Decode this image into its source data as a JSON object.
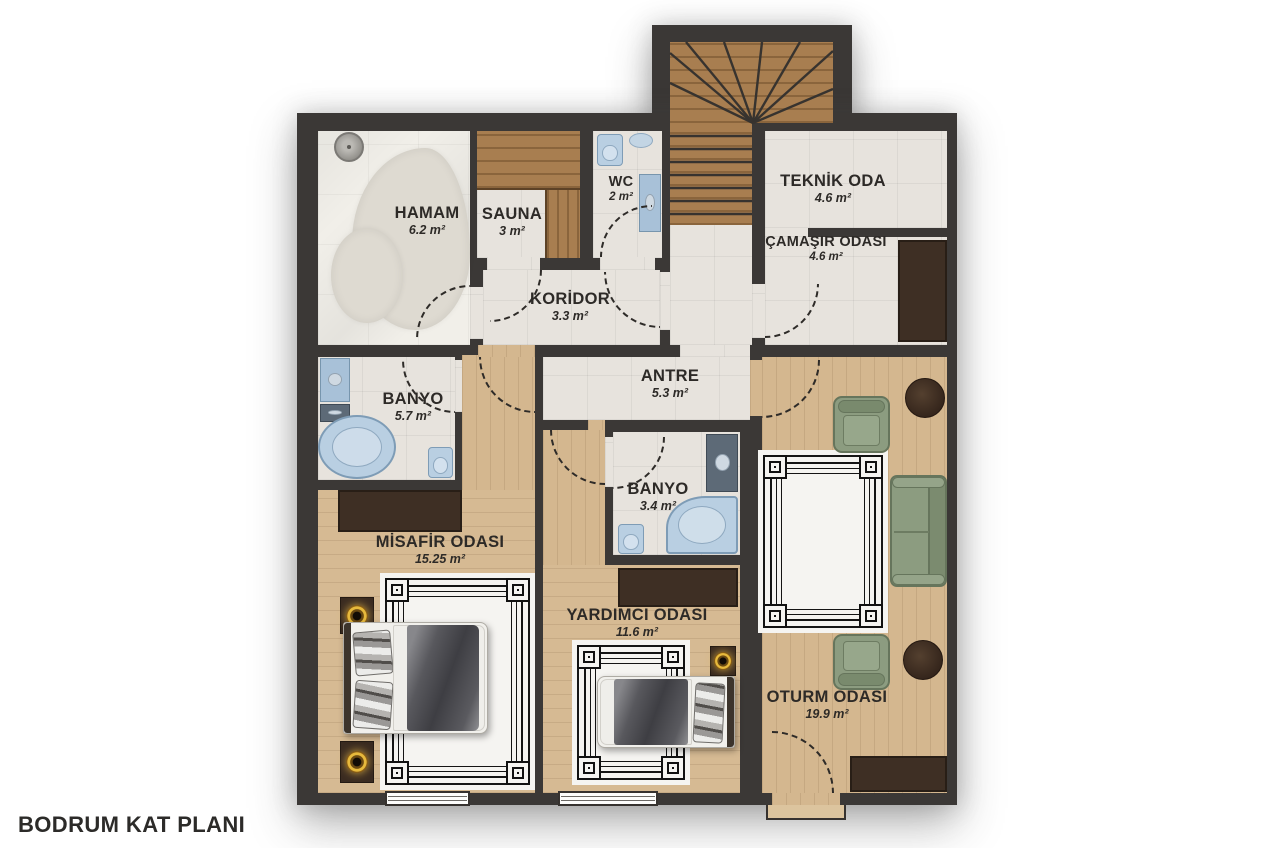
{
  "plan": {
    "title": "BODRUM KAT PLANI",
    "rooms": [
      {
        "id": "hamam",
        "label": "HAMAM",
        "area": "6.2 m²"
      },
      {
        "id": "sauna",
        "label": "SAUNA",
        "area": "3 m²"
      },
      {
        "id": "wc",
        "label": "WC",
        "area": "2 m²"
      },
      {
        "id": "teknik-oda",
        "label": "TEKNİK ODA",
        "area": "4.6 m²"
      },
      {
        "id": "camasir-odasi",
        "label": "ÇAMAŞIR ODASI",
        "area": "4.6 m²"
      },
      {
        "id": "koridor",
        "label": "KORİDOR",
        "area": "3.3 m²"
      },
      {
        "id": "antre",
        "label": "ANTRE",
        "area": "5.3 m²"
      },
      {
        "id": "banyo-1",
        "label": "BANYO",
        "area": "5.7 m²"
      },
      {
        "id": "banyo-2",
        "label": "BANYO",
        "area": "3.4 m²"
      },
      {
        "id": "misafir-odasi",
        "label": "MİSAFİR ODASI",
        "area": "15.25 m²"
      },
      {
        "id": "yardimci-odasi",
        "label": "YARDIMCI ODASI",
        "area": "11.6 m²"
      },
      {
        "id": "oturma-odasi",
        "label": "OTURM ODASI",
        "area": "19.9 m²"
      }
    ],
    "colors": {
      "wall": "#3b3836",
      "tile": "#e7e3dd",
      "marble": "#f1efe9",
      "wood": "#d4b78f",
      "sauna_wood": "#a87e50",
      "fixture_blue": "#b9cfe2",
      "furniture_green": "#8c9c80",
      "furniture_brown": "#3e2f24",
      "rug": "#f5f4f1",
      "label_ink": "#2d2a27"
    }
  }
}
